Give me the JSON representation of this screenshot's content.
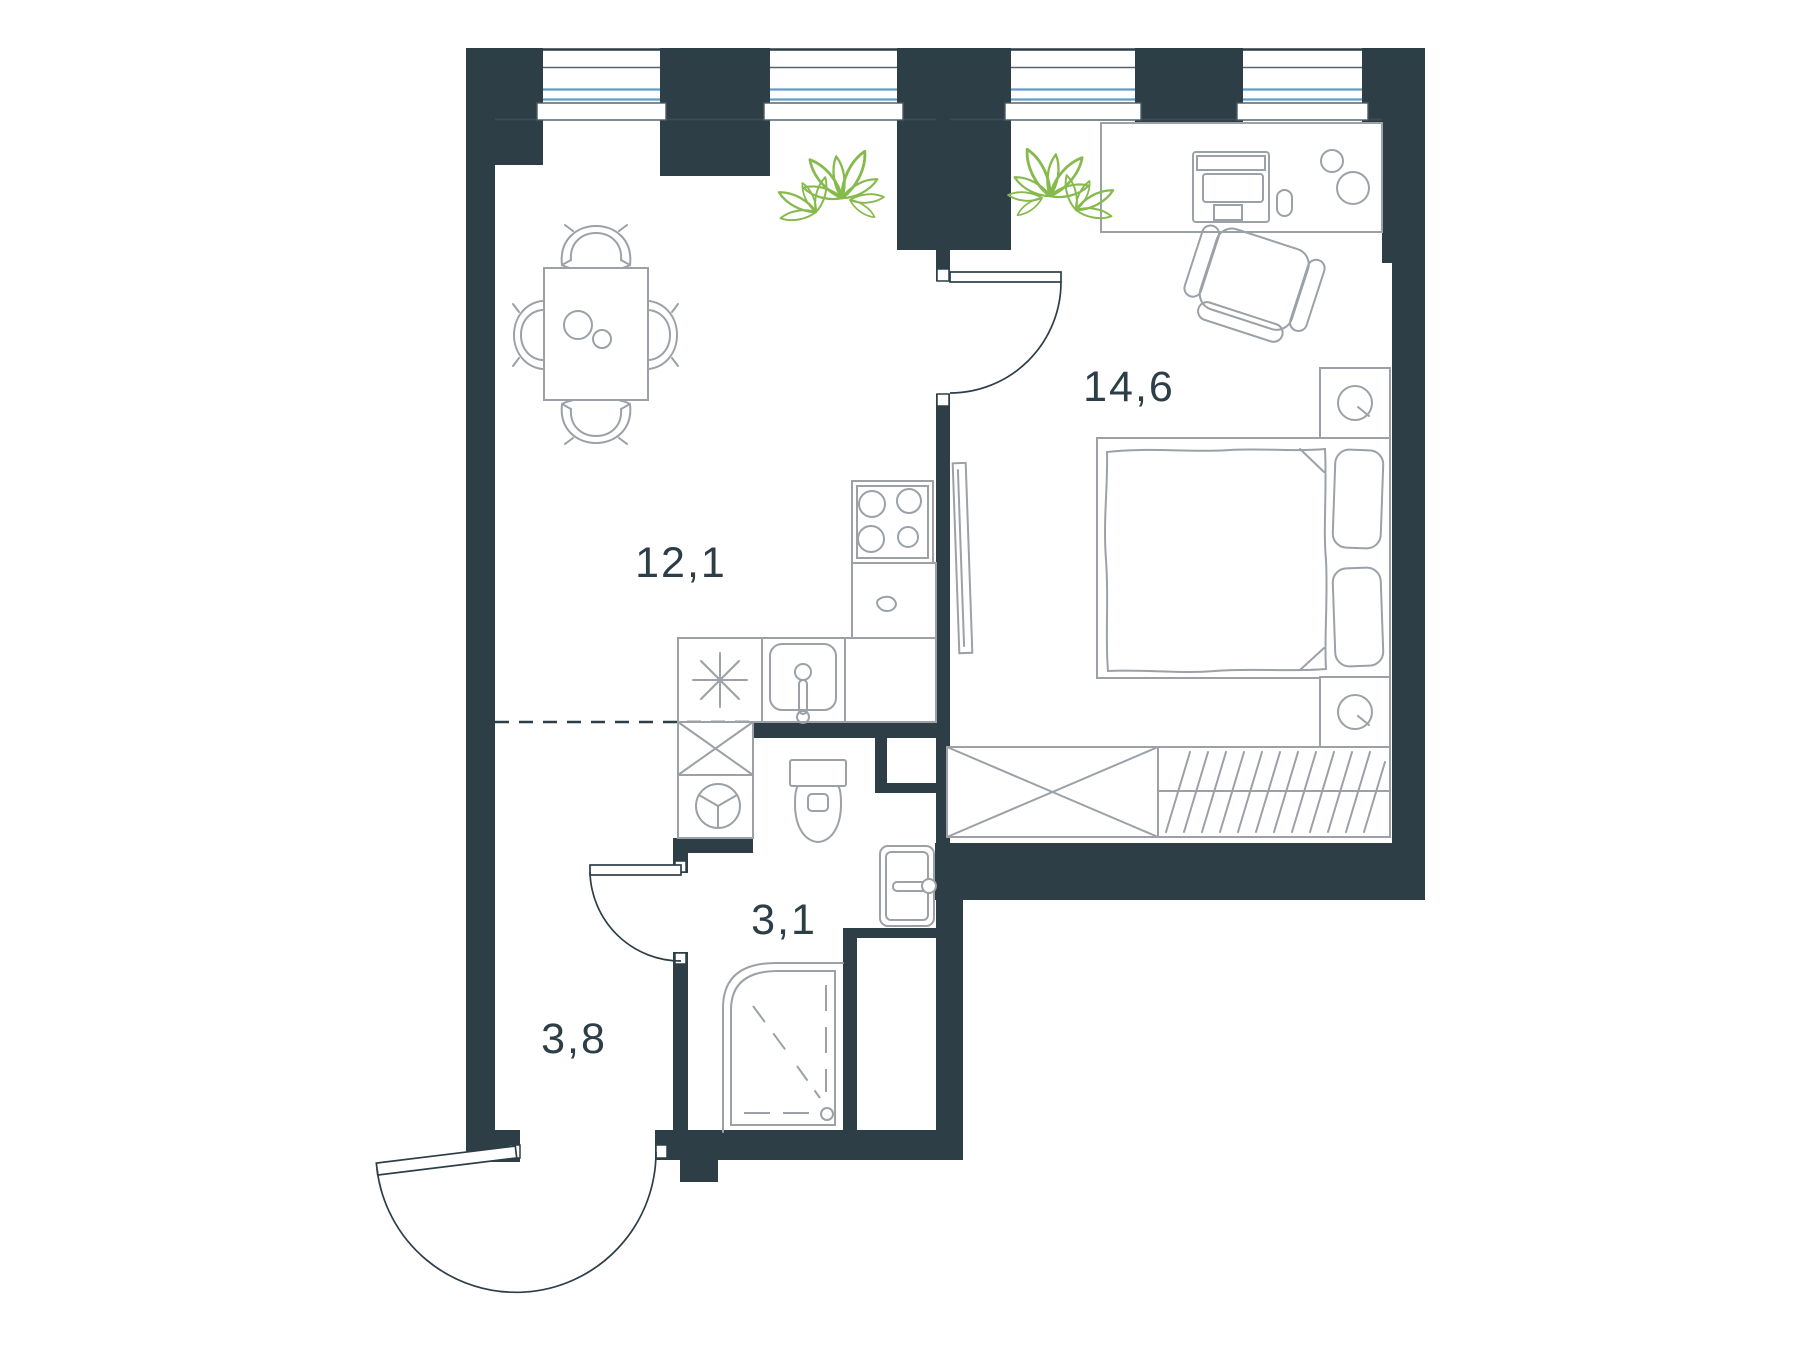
{
  "title": "apartment-floor-plan",
  "colors": {
    "wall": "#2d3e47",
    "furniture_outline": "#9ba1a6",
    "window_glass": "#5e9ec9",
    "plant": "#86ba4c",
    "background": "#ffffff"
  },
  "rooms": {
    "kitchen_living": {
      "name": "kitchen-living-room",
      "area": "12,1"
    },
    "bedroom": {
      "name": "bedroom",
      "area": "14,6"
    },
    "bathroom": {
      "name": "bathroom",
      "area": "3,1"
    },
    "hallway": {
      "name": "hallway",
      "area": "3,8"
    }
  },
  "windows": {
    "count": 4
  },
  "fixtures": {
    "kitchen_living": [
      "dining-table",
      "dining-chairs",
      "plates",
      "stove",
      "kitchen-counter",
      "kitchen-sink",
      "refrigerator",
      "washing-machine",
      "plant"
    ],
    "bedroom": [
      "desk",
      "computer",
      "mouse",
      "desk-chair",
      "cups",
      "double-bed",
      "blanket",
      "pillows",
      "nightstands",
      "table-lamps",
      "tv",
      "wardrobe",
      "hanging-rail",
      "plant"
    ],
    "bathroom": [
      "toilet",
      "shower-cabin",
      "utility-door",
      "plumbing-shaft"
    ],
    "hallway": [
      "entry-door",
      "bathroom-door"
    ]
  }
}
